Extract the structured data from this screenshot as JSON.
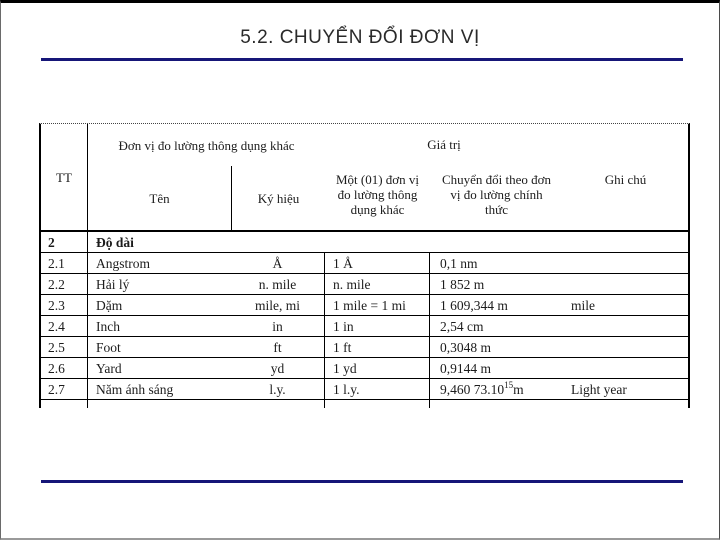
{
  "slide": {
    "title": "5.2. CHUYỂN ĐỔI ĐƠN VỊ",
    "accent_color": "#161678"
  },
  "table": {
    "header": {
      "tt": "TT",
      "units_group": "Đơn vị đo lường thông dụng khác",
      "name": "Tên",
      "symbol": "Ký hiệu",
      "value_group": "Giá trị",
      "one_unit": "Một (01) đơn vị đo lường thông dụng khác",
      "conversion": "Chuyển đổi theo đơn vị đo lường chính thức",
      "notes": "Ghi chú"
    },
    "section": {
      "tt": "2",
      "label": "Độ dài"
    },
    "rows": [
      {
        "tt": "2.1",
        "name": "Angstrom",
        "symbol": "Å",
        "one_unit": "1 Å",
        "conversion": "0,1 nm",
        "notes": ""
      },
      {
        "tt": "2.2",
        "name": "Hải lý",
        "symbol": "n. mile",
        "one_unit": "n. mile",
        "conversion": "1 852 m",
        "notes": ""
      },
      {
        "tt": "2.3",
        "name": "Dặm",
        "symbol": "mile, mi",
        "one_unit": "1 mile = 1 mi",
        "conversion": "1 609,344 m",
        "notes": "mile"
      },
      {
        "tt": "2.4",
        "name": "Inch",
        "symbol": "in",
        "one_unit": "1 in",
        "conversion": "2,54 cm",
        "notes": ""
      },
      {
        "tt": "2.5",
        "name": "Foot",
        "symbol": "ft",
        "one_unit": "1 ft",
        "conversion": "0,3048 m",
        "notes": ""
      },
      {
        "tt": "2.6",
        "name": "Yard",
        "symbol": "yd",
        "one_unit": "1 yd",
        "conversion": "0,9144 m",
        "notes": ""
      },
      {
        "tt": "2.7",
        "name": "Năm ánh sáng",
        "symbol": "l.y.",
        "one_unit": "1 l.y.",
        "conv_base": "9,460 73.10",
        "conv_exp": "15",
        "conv_tail": " m",
        "notes": "Light year"
      }
    ]
  }
}
